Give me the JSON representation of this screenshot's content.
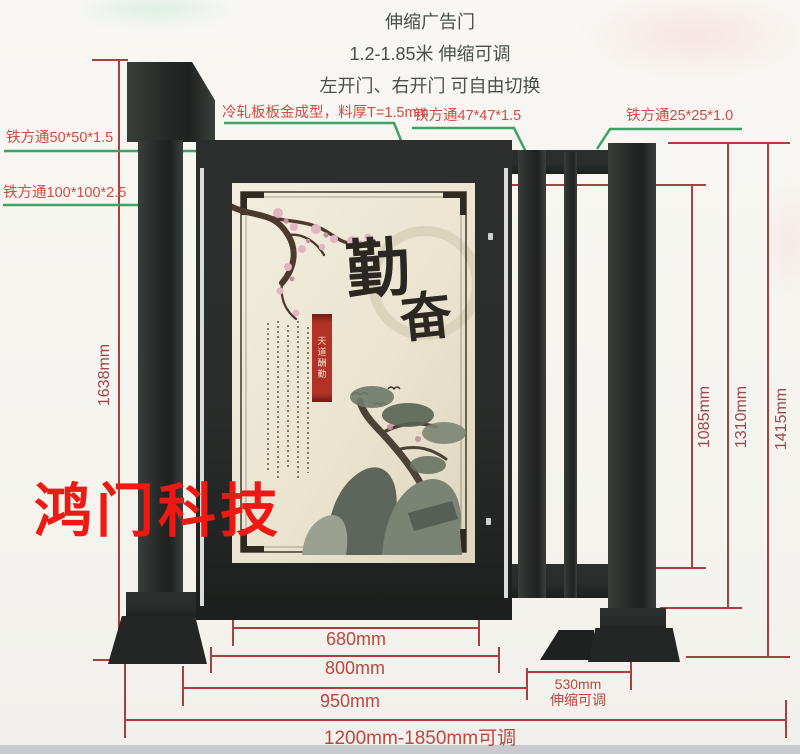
{
  "title": {
    "line1": "伸缩广告门",
    "line2": "1.2-1.85米 伸缩可调",
    "line3": "左开门、右开门 可自由切换"
  },
  "callouts": {
    "tube50": "铁方通50*50*1.5",
    "tube100": "铁方通100*100*2.5",
    "cold_rolled": "冷轧板板金成型，料厚T=1.5mm",
    "tube47": "铁方通47*47*1.5",
    "tube25": "铁方通25*25*1.0"
  },
  "dimensions": {
    "total_height": "1638mm",
    "inner_height": "1085mm",
    "post_height": "1310mm",
    "frame_height": "1415mm",
    "poster_width": "680mm",
    "door_width": "800mm",
    "panel_width": "950mm",
    "tele_width": "530mm",
    "tele_note": "伸缩可调",
    "total_width": "1200mm-1850mm可调"
  },
  "watermark": "鸿门科技",
  "poster": {
    "calligraphy_top": "勤",
    "calligraphy_bottom": "奋",
    "banner_text": "天道酬勤"
  },
  "colors": {
    "dimension_red": "#a8403f",
    "label_red": "#d24b44",
    "leader_green": "#3da164",
    "gate_dark": "#2b2e2c",
    "poster_cream": "#ece6d3",
    "watermark_red": "#ec1a12"
  }
}
